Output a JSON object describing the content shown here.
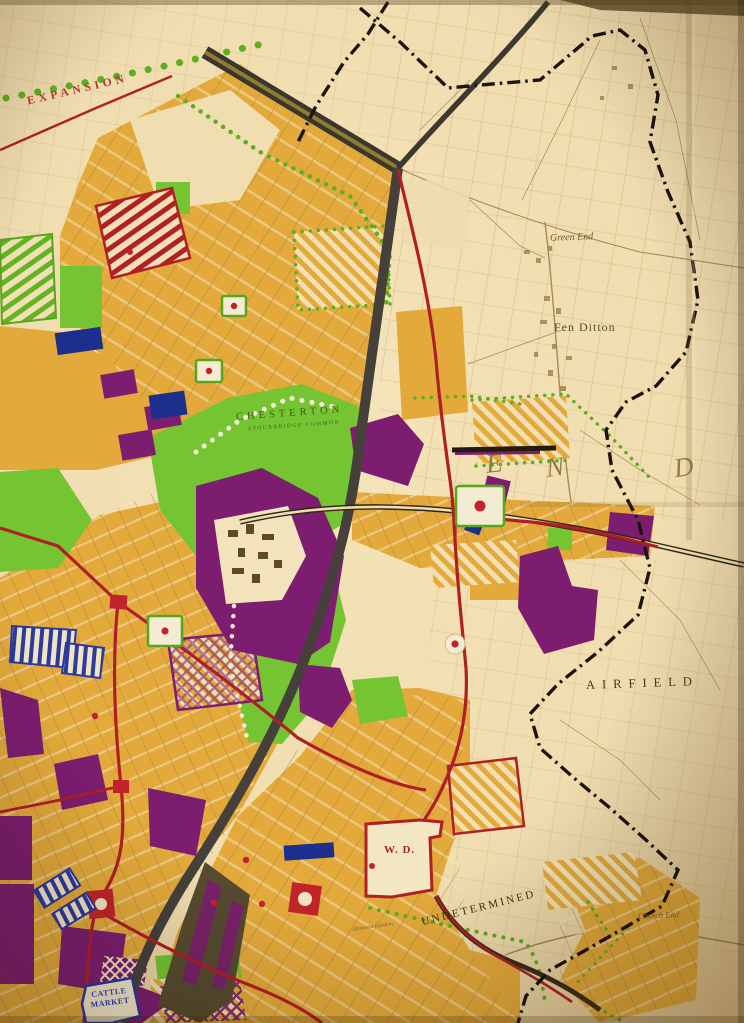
{
  "map": {
    "description": "Sepia town-planning proposals map photograph",
    "labels": {
      "expansion": "EXPANSION",
      "green_end": "Green End",
      "fen_ditton": "Fen Ditton",
      "chesterton": "CHESTERTON",
      "stourbridge_common": "STOURBRIDGE COMMON",
      "district_letters": [
        "E",
        "N",
        "D"
      ],
      "airfield": "AIRFIELD",
      "war_department": "W. D.",
      "undetermined": "UNDETERMINED",
      "cattle_market_line1": "CATTLE",
      "cattle_market_line2": "MARKET",
      "church_end": "Church End",
      "allotment_gardens": "Allotment Gardens"
    },
    "palette": {
      "paper": "#f1dfb2",
      "residential_orange": "#e3a93a",
      "open_space_green": "#74c531",
      "industry_purple": "#7c1d6f",
      "road_red": "#ae1f26",
      "railway_grey": "#45403a",
      "public_building_blue": "#1d2f8c",
      "boundary_black": "#1c150d",
      "base_detail_sepia": "#8a6f3a"
    }
  }
}
